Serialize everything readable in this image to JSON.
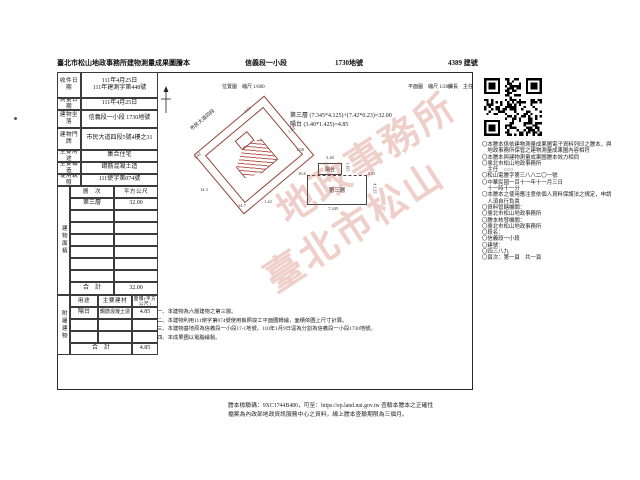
{
  "header": {
    "title": "臺北市松山地政事務所建物測量成果圖謄本",
    "section": "信義段一小段",
    "land_no": "1730地號",
    "building_no": "4389 建號"
  },
  "scales": {
    "location": "位置圖　縮尺 1/600",
    "plan": "平面圖　縮尺 1/200",
    "sign": "課長　主任"
  },
  "info": {
    "rows": [
      {
        "label": "收件日期",
        "value": "111年4月25日",
        "value2": "111年建測字第448號"
      },
      {
        "label": "測量日期",
        "value": "111年4月25日",
        "value2": ""
      },
      {
        "label": "建物坐落",
        "value": "信義段一小段 1730地號",
        "value2": ""
      },
      {
        "label": "建物門牌",
        "value": "市民大道四段5號4樓之31",
        "value2": ""
      },
      {
        "label": "主要用途",
        "value": "集合住宅",
        "value2": ""
      },
      {
        "label": "主要構造",
        "value": "鋼筋混凝土造",
        "value2": ""
      },
      {
        "label": "使用執照",
        "value": "111使字第074號",
        "value2": ""
      }
    ]
  },
  "area": {
    "title": "建物面積",
    "col_floor": "層　次",
    "col_area": "平方公尺",
    "floor": "第三層",
    "floor_area": "32.00",
    "total_label": "合　計",
    "total": "32.00"
  },
  "annex": {
    "title": "附屬建物",
    "col_use": "用途",
    "col_material": "主要建材",
    "col_area": "面積(平方公尺)",
    "use": "陽台",
    "material": "鋼筋混凝土造",
    "area_value": "4.85",
    "total_label": "合　計",
    "total": "4.85"
  },
  "formula": {
    "line1": "第三層 (7.345*4.125)+(7.42*0.23)=32.00",
    "line2": "陽台 (3.40*1.425)=4.85"
  },
  "plan": {
    "balcony": "陽台",
    "floor": "第三層",
    "dim_top": "3.40",
    "dim_right": "1.425",
    "dim_ext": "0.23",
    "dim_h": "4.125",
    "dim_w": "7.345"
  },
  "location": {
    "street": "市民大道四段",
    "dims": [
      "4.61",
      "1.62",
      "1.42",
      "14.3",
      "1.58",
      "14.7",
      "1.42",
      "16.6"
    ]
  },
  "notes": [
    "一、本建物為六層建物之第三層。",
    "二、本建物利用111使字第074號使用執照竣工平面圖轉繪，面積依圖上尺寸計算。",
    "三、本建物基地原為信義段一小段17-1地號，110年1月9日逕為分割為信義段一小段1730地號。",
    "四、本成果圖以電腦繪製。"
  ],
  "sidebar": [
    "〇本謄本係依建物測量成果圖電子資料列印之謄本，與",
    "　地政事務所保管之建物測量成果圖內容相符",
    "〇本謄本與建物測量成果圖謄本效力相同",
    "〇臺北市松山地政事務所",
    "　主任　○○○",
    "〇松山電謄字第三八八二〇一號",
    "〇中華民國一百十一年十一月三日",
    "　十一時十一分",
    "〇本謄本之使用應注意依個人資料保護法之規定，申請",
    "　人須自行負責",
    "〇資料管轄機關：",
    "〇臺北市松山地政事務所",
    "〇謄本核發機關：",
    "〇臺北市松山地政事務所",
    "〇段名：",
    "〇信義段一小段",
    "〇建號：",
    "〇四三八九",
    "〇頁次：第一頁　共一頁"
  ],
  "footer": {
    "line1": "謄本檢驗碼：9XC1744B480，可至：https://ep.land.nat.gov.tw 查驗本謄本之正確性",
    "line2": "檔案為內政部地政資訊服務中心之資料，線上謄本查驗期限為三個月。"
  },
  "watermark": {
    "line1": "臺北市松山",
    "line2": "地政事務所"
  }
}
